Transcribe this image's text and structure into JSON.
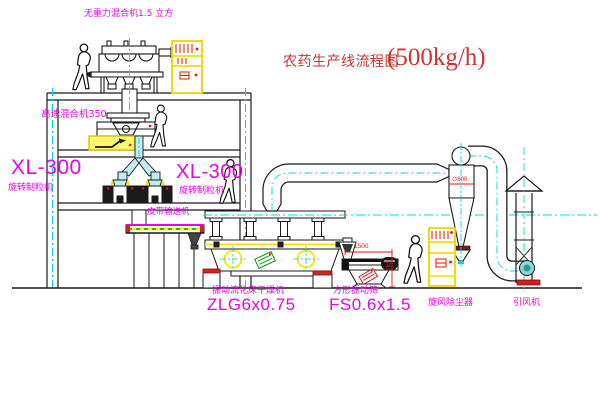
{
  "diagram": {
    "title": {
      "name": "农药生产线流程图",
      "capacity": "(500kg/h)"
    },
    "labels": {
      "gravity_mixer": "无重力混合机1.5 立方",
      "high_speed_mixer": "高速混合机350",
      "granulator_left_model": "XL-300",
      "granulator_left_name": "旋转制粒机",
      "granulator_mid_model": "XL-300",
      "granulator_mid_name": "旋转制粒机",
      "belt_conveyor": "皮带输送机",
      "dryer_name": "振动流化床干燥机",
      "dryer_model": "ZLG6x0.75",
      "sieve_name": "方形振动筛",
      "sieve_model": "FS0.6x1.5",
      "cyclone": "旋风除尘器",
      "fan": "引风机"
    },
    "dimensions": {
      "cyclone_diameter": "∅800",
      "sieve_length": "1500",
      "sieve_height": "741"
    },
    "colors": {
      "label_magenta": "#e605e6",
      "title_red": "#cc3333",
      "dimension_red": "#ee1111",
      "centerline_cyan": "#00dcdc",
      "highlight_yellow": "#f7e600",
      "chute_cyan": "#c2eef2",
      "line_black": "#1a1a1a"
    }
  }
}
